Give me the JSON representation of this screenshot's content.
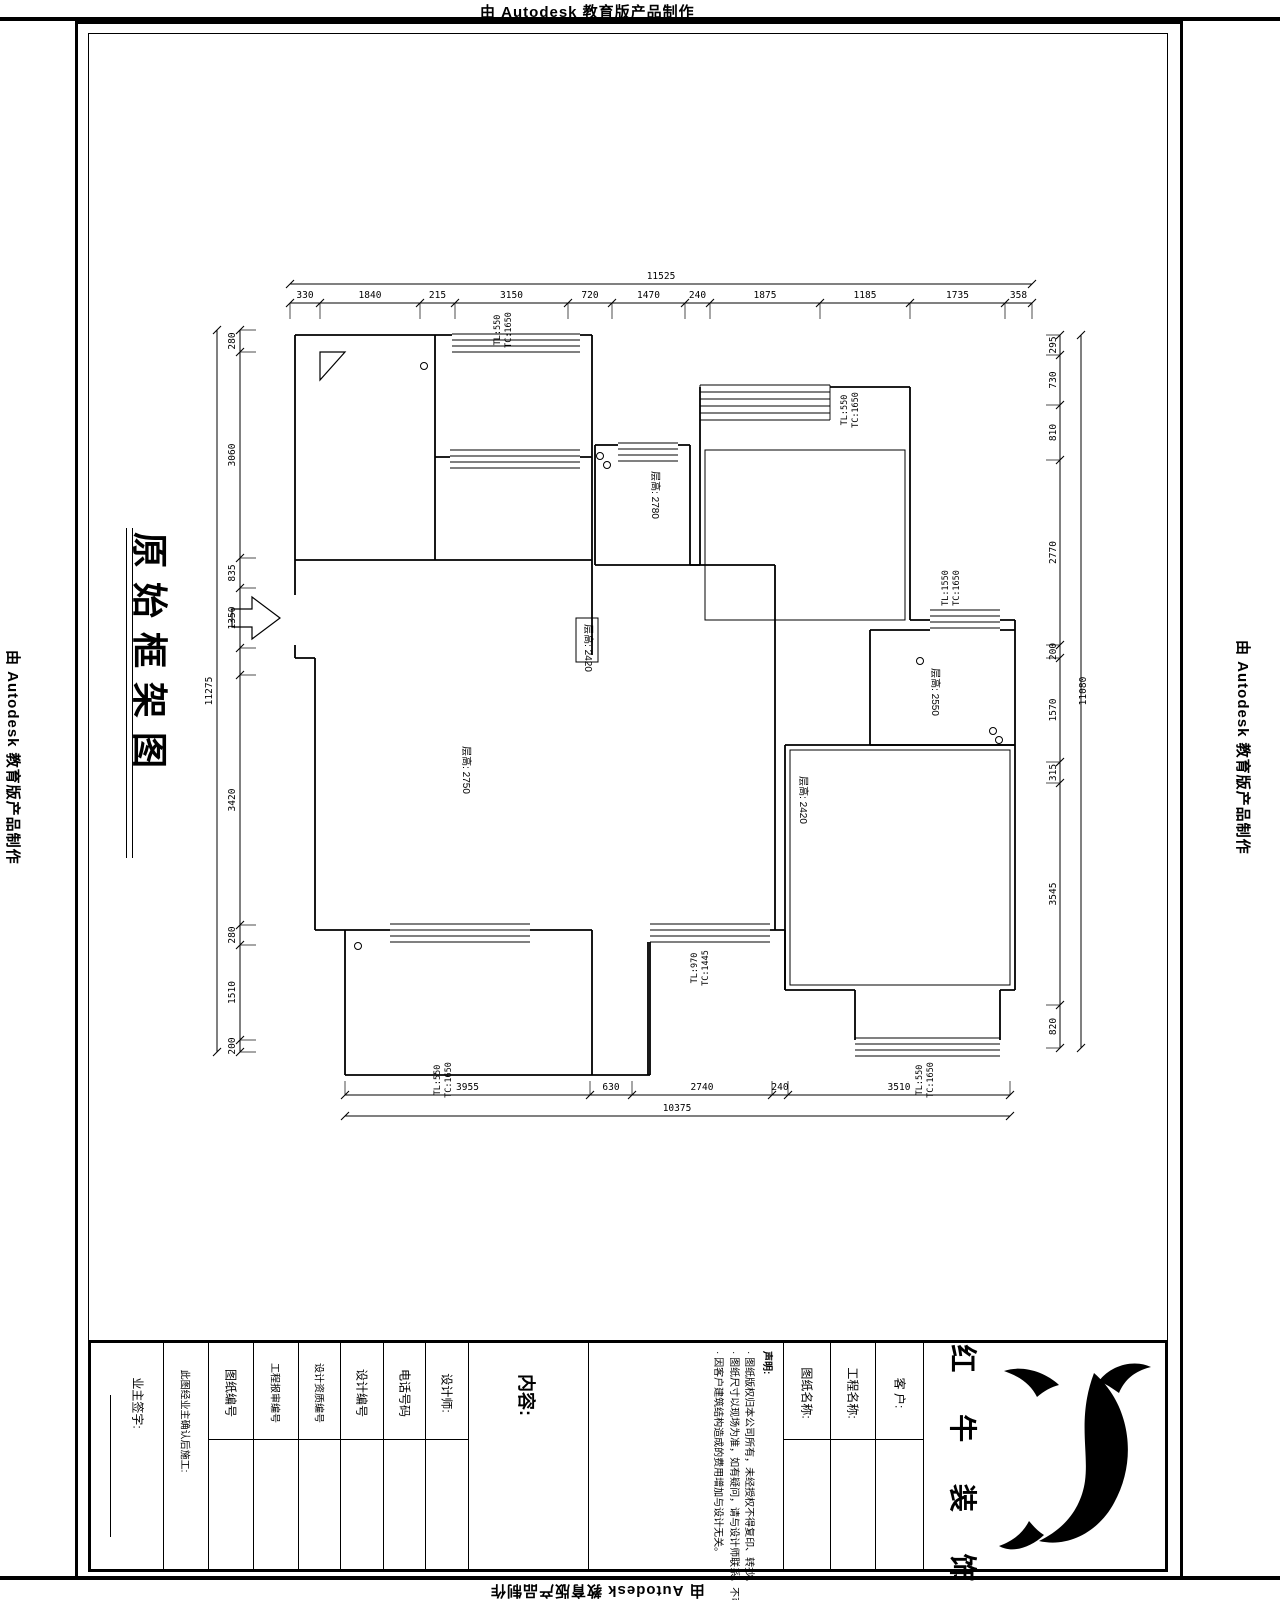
{
  "stamp": "由 Autodesk 教育版产品制作",
  "sheet": {
    "title": "原始框架图"
  },
  "dimensions": {
    "top": {
      "total": "11525",
      "segments": [
        "330",
        "1840",
        "215",
        "3150",
        "720",
        "1470",
        "240",
        "1875",
        "1185",
        "1735",
        "358"
      ]
    },
    "bottom": {
      "total": "10375",
      "segments": [
        "3955",
        "630",
        "2740",
        "240",
        "3510"
      ]
    },
    "left": {
      "total": "11275",
      "segments": [
        "280",
        "3060",
        "835",
        "1350",
        "",
        "3420",
        "280",
        "1510",
        "200"
      ]
    },
    "right": {
      "total": "11080",
      "segments": [
        "295",
        "730",
        "810",
        "2770",
        "200",
        "1570",
        "315",
        "3545",
        "820"
      ]
    }
  },
  "plan": {
    "room_labels": [
      "层高: 2750",
      "层高: 2780",
      "层高: 2420",
      "层高: 2420",
      "层高: 2550"
    ],
    "window_notes": [
      {
        "tl": "TL:550",
        "tc": "TC:1650"
      },
      {
        "tl": "TL:550",
        "tc": "TC:1650"
      },
      {
        "tl": "TL:1550",
        "tc": "TC:1650"
      },
      {
        "tl": "TL:970",
        "tc": "TC:1445"
      },
      {
        "tl": "TL:550",
        "tc": "TC:1650"
      },
      {
        "tl": "TL:550",
        "tc": "TC:1650"
      }
    ]
  },
  "title_block": {
    "owner_label": "业主签字:",
    "owner_note": "此图经业主确认后施工:",
    "fields": [
      {
        "label": "图纸编号"
      },
      {
        "label": "工程报审编号"
      },
      {
        "label": "设计资质编号"
      },
      {
        "label": "设计编号"
      },
      {
        "label": "电话号码"
      },
      {
        "label": "设计师:"
      }
    ],
    "content_label": "内容:",
    "statement": {
      "title": "声明:",
      "items": [
        "· 图纸版权归本公司所有，未经授权不得复印、转抄。",
        "· 图纸尺寸以现场为准，如有疑问，请与设计师联系，不可度量本图。",
        "· 因客户建筑结构造成的费用增加与设计无关。"
      ]
    },
    "name_fields": [
      {
        "label": "图纸名称:"
      },
      {
        "label": "工程名称:"
      },
      {
        "label": "客 户:"
      }
    ],
    "logo_text": "红 牛 装 饰"
  }
}
